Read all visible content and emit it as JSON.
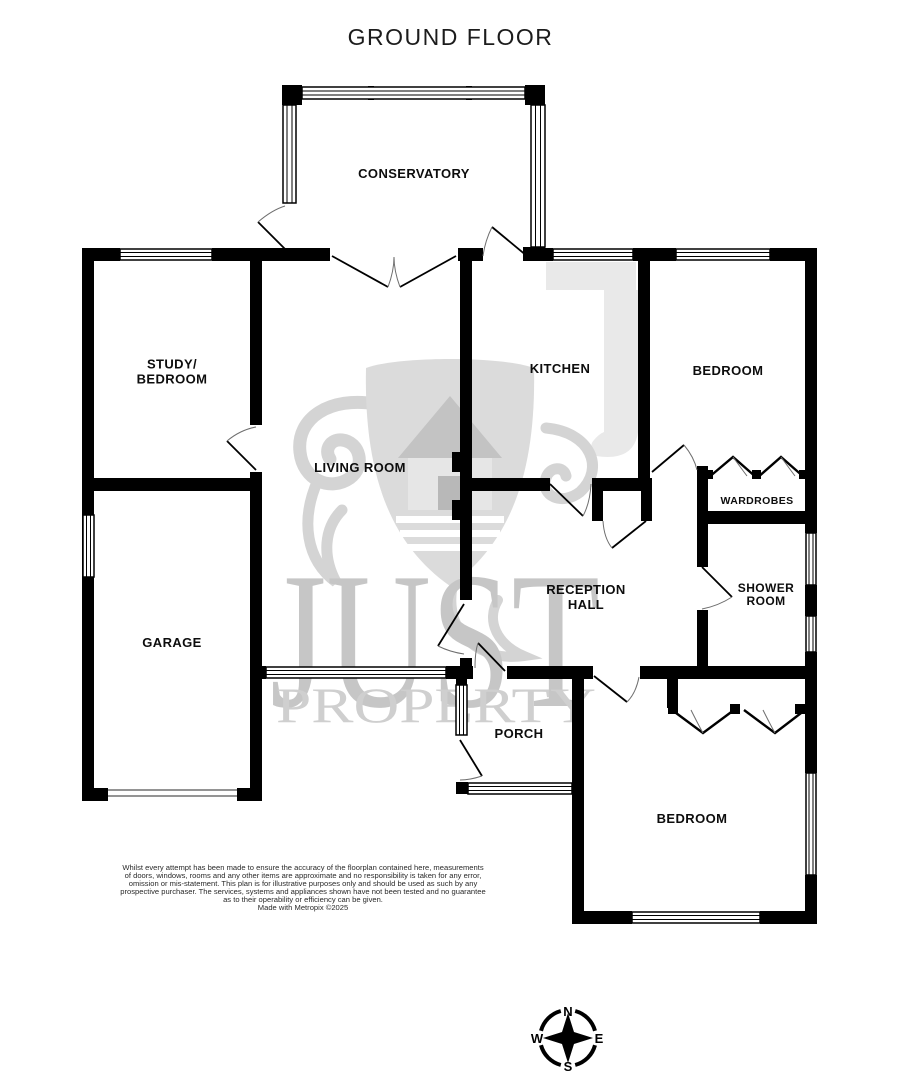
{
  "title": "GROUND FLOOR",
  "rooms": {
    "conservatory": "CONSERVATORY",
    "study_line1": "STUDY/",
    "study_line2": "BEDROOM",
    "kitchen": "KITCHEN",
    "bedroom_top": "BEDROOM",
    "living": "LIVING ROOM",
    "wardrobes": "WARDROBES",
    "garage": "GARAGE",
    "reception_line1": "RECEPTION",
    "reception_line2": "HALL",
    "shower_line1": "SHOWER",
    "shower_line2": "ROOM",
    "porch": "PORCH",
    "bedroom_bottom": "BEDROOM"
  },
  "watermark": {
    "name_top": "JUST",
    "name_bottom": "PROPERTY"
  },
  "compass": {
    "north": "N",
    "east": "E",
    "south": "S",
    "west": "W"
  },
  "disclaimer": {
    "lines": [
      "Whilst every attempt has been made to ensure the accuracy of the floorplan contained here, measurements",
      "of doors, windows, rooms and any other items are approximate and no responsibility is taken for any error,",
      "omission or mis-statement. This plan is for illustrative purposes only and should be used as such by any",
      "prospective purchaser. The services, systems and appliances shown have not been tested and no guarantee",
      "as to their operability or efficiency can be given.",
      "Made with Metropix ©2025"
    ]
  },
  "colors": {
    "wall": "#000000",
    "watermark_light": "#e9e9e9",
    "watermark_mid": "#dbdbdb",
    "watermark_text": "#c6c6c6"
  }
}
